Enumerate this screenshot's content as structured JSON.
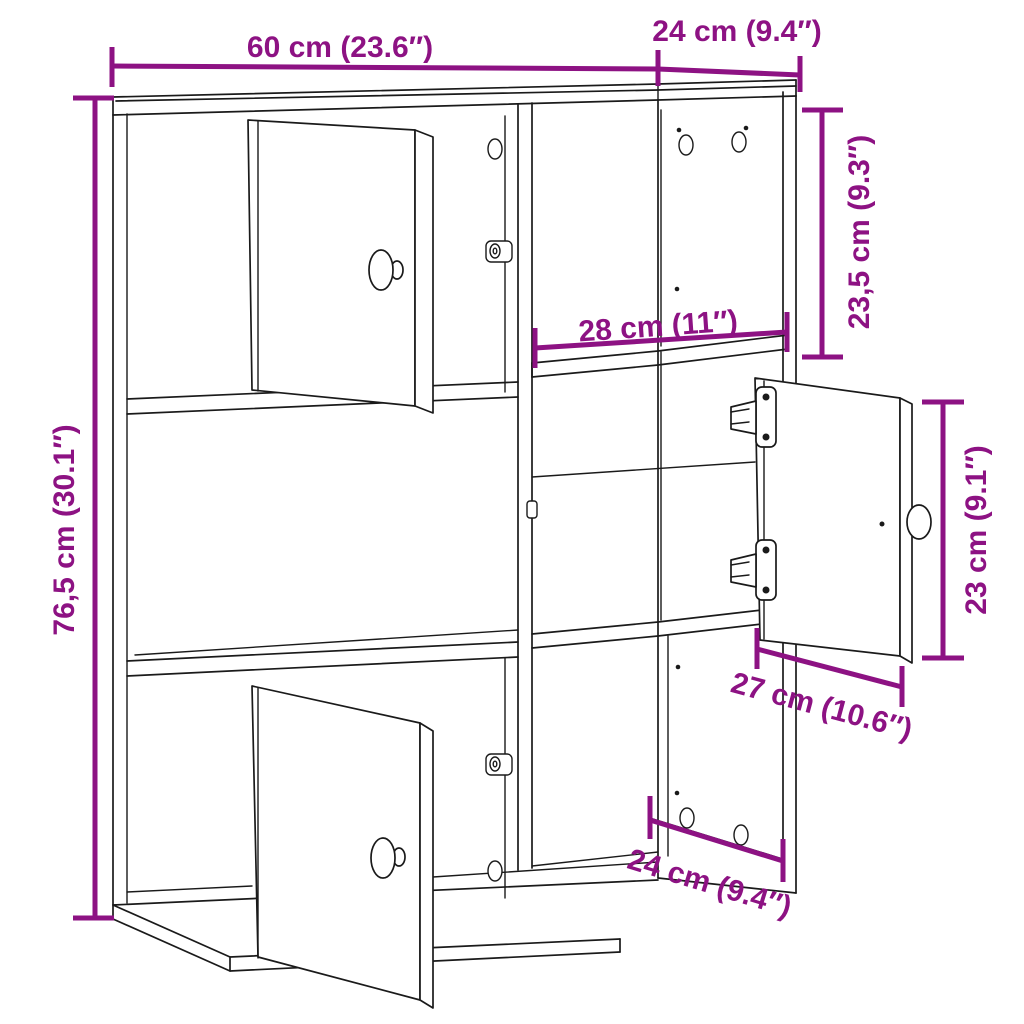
{
  "diagram": {
    "accent_color": "#8d1283",
    "line_color": "#1a1a1a",
    "background_color": "#ffffff",
    "dimensions": {
      "width_top": "60 cm (23.6″)",
      "depth_top": "24 cm (9.4″)",
      "height_left": "76,5 cm (30.1″)",
      "upper_section_height": "23,5 cm (9.3″)",
      "inner_shelf_width": "28 cm (11″)",
      "door_height_right": "23 cm (9.1″)",
      "door_width_right": "27 cm (10.6″)",
      "depth_bottom": "24 cm (9.4″)"
    }
  }
}
